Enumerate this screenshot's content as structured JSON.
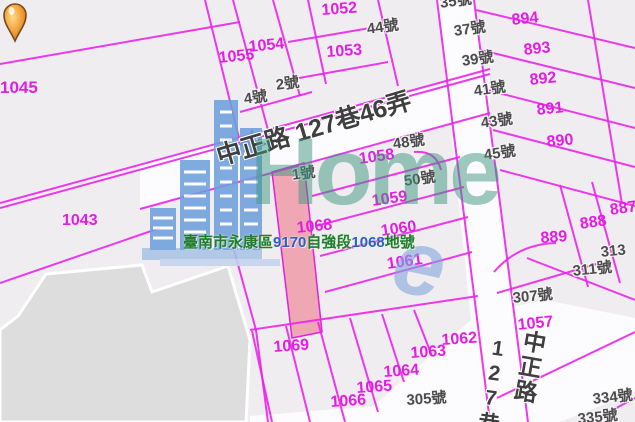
{
  "map": {
    "colors": {
      "background": "#f0edf0",
      "road_fill": "#fcfbfd",
      "parcel_line": "#ea24ea",
      "parcel_text": "#e41de4",
      "house_text": "#4c4c4c",
      "road_text": "#3f3f3f",
      "highlight_parcel_fill": "#ef8fa0",
      "building_footprint": "#dcdddc",
      "pin_orange": "#f2a33c",
      "site_text_green": "#1f7d2c",
      "site_text_blue": "#2f5fc0",
      "watermark_teal": "rgba(60,150,125,0.5)",
      "watermark_blue": "#7aa8e0"
    },
    "site_label": {
      "segments": [
        {
          "text": "臺南市永康區",
          "color": "green"
        },
        {
          "text": "9170",
          "color": "blue"
        },
        {
          "text": "自強段",
          "color": "green"
        },
        {
          "text": "1068",
          "color": "blue"
        },
        {
          "text": "地號",
          "color": "green"
        }
      ]
    },
    "watermark": {
      "brand": "Home",
      "glyph": "e"
    },
    "road_labels": [
      {
        "t": "中正路 127巷46弄",
        "x": 214,
        "y": 146,
        "r": -16.5,
        "s": 25,
        "v": false
      },
      {
        "t": "127巷",
        "x": 489,
        "y": 336,
        "r": 8,
        "s": 21,
        "v": true
      },
      {
        "t": "中正路",
        "x": 523,
        "y": 328,
        "r": 10,
        "s": 23,
        "v": true
      }
    ],
    "parcel_labels": [
      {
        "t": "1045",
        "x": 0,
        "y": 79,
        "r": 0,
        "s": 17
      },
      {
        "t": "1043",
        "x": 62,
        "y": 213,
        "r": 0,
        "s": 16
      },
      {
        "t": "1052",
        "x": 321,
        "y": 3,
        "r": -4,
        "s": 16
      },
      {
        "t": "1053",
        "x": 326,
        "y": 45,
        "r": -4,
        "s": 16
      },
      {
        "t": "1054",
        "x": 248,
        "y": 40,
        "r": -6,
        "s": 16
      },
      {
        "t": "1055",
        "x": 218,
        "y": 51,
        "r": -6,
        "s": 16
      },
      {
        "t": "894",
        "x": 511,
        "y": 13,
        "r": -6,
        "s": 16
      },
      {
        "t": "893",
        "x": 523,
        "y": 43,
        "r": -6,
        "s": 16
      },
      {
        "t": "892",
        "x": 529,
        "y": 73,
        "r": -6,
        "s": 16
      },
      {
        "t": "891",
        "x": 536,
        "y": 103,
        "r": -6,
        "s": 16
      },
      {
        "t": "890",
        "x": 546,
        "y": 135,
        "r": -6,
        "s": 16
      },
      {
        "t": "889",
        "x": 540,
        "y": 231,
        "r": -4,
        "s": 16
      },
      {
        "t": "888",
        "x": 579,
        "y": 217,
        "r": -8,
        "s": 16
      },
      {
        "t": "887",
        "x": 609,
        "y": 203,
        "r": -8,
        "s": 16
      },
      {
        "t": "1058",
        "x": 358,
        "y": 152,
        "r": -8,
        "s": 16
      },
      {
        "t": "1059",
        "x": 371,
        "y": 194,
        "r": -8,
        "s": 16
      },
      {
        "t": "1060",
        "x": 380,
        "y": 224,
        "r": -8,
        "s": 16
      },
      {
        "t": "1061",
        "x": 386,
        "y": 257,
        "r": -8,
        "s": 16
      },
      {
        "t": "1068",
        "x": 296,
        "y": 221,
        "r": -6,
        "s": 16
      },
      {
        "t": "1057",
        "x": 517,
        "y": 318,
        "r": -6,
        "s": 16
      },
      {
        "t": "1062",
        "x": 441,
        "y": 333,
        "r": -4,
        "s": 16
      },
      {
        "t": "1063",
        "x": 410,
        "y": 346,
        "r": -4,
        "s": 16
      },
      {
        "t": "1064",
        "x": 383,
        "y": 365,
        "r": -4,
        "s": 16
      },
      {
        "t": "1065",
        "x": 356,
        "y": 381,
        "r": -4,
        "s": 16
      },
      {
        "t": "1066",
        "x": 330,
        "y": 395,
        "r": -4,
        "s": 16
      },
      {
        "t": "1069",
        "x": 273,
        "y": 340,
        "r": -4,
        "s": 16
      }
    ],
    "house_labels": [
      {
        "t": "44號",
        "x": 366,
        "y": 22,
        "r": -8
      },
      {
        "t": "4號",
        "x": 243,
        "y": 92,
        "r": -8
      },
      {
        "t": "2號",
        "x": 275,
        "y": 78,
        "r": -8
      },
      {
        "t": "1號",
        "x": 291,
        "y": 168,
        "r": -8
      },
      {
        "t": "48號",
        "x": 392,
        "y": 137,
        "r": -8
      },
      {
        "t": "50號",
        "x": 403,
        "y": 174,
        "r": -8
      },
      {
        "t": "35號",
        "x": 439,
        "y": -4,
        "r": -8
      },
      {
        "t": "37號",
        "x": 453,
        "y": 24,
        "r": -8
      },
      {
        "t": "39號",
        "x": 461,
        "y": 54,
        "r": -8
      },
      {
        "t": "41號",
        "x": 473,
        "y": 84,
        "r": -8
      },
      {
        "t": "43號",
        "x": 480,
        "y": 116,
        "r": -8
      },
      {
        "t": "45號",
        "x": 483,
        "y": 148,
        "r": -8
      },
      {
        "t": "307號",
        "x": 512,
        "y": 291,
        "r": -6
      },
      {
        "t": "311號",
        "x": 572,
        "y": 264,
        "r": -6
      },
      {
        "t": "313",
        "x": 600,
        "y": 245,
        "r": -6
      },
      {
        "t": "305號",
        "x": 406,
        "y": 393,
        "r": -4
      },
      {
        "t": "334號",
        "x": 592,
        "y": 392,
        "r": -6
      },
      {
        "t": "335號",
        "x": 577,
        "y": 412,
        "r": -6
      }
    ]
  }
}
